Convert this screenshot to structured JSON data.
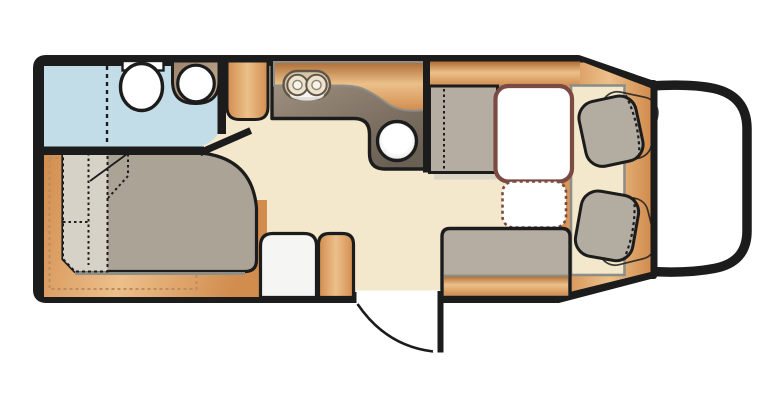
{
  "meta": {
    "type": "floorplan",
    "subject": "semi-integrated motorhome layout, top view",
    "orientation": "driver cab on the right, rear bedroom on the left"
  },
  "palette": {
    "outline": "#1c1c1c",
    "floor": "#f3e8cb",
    "washroomFloor": "#c3dde8",
    "woodLight": "#ecc08a",
    "woodMid": "#d28c4e",
    "woodDark": "#ad6c36",
    "counterLight": "#a79786",
    "counterDark": "#6b6054",
    "cushionGrey": "#b5ada1",
    "mattressGrey": "#aba396",
    "mattressLight": "#d7d2c8",
    "tableBorder": "#7b4a42",
    "seatGrey": "#b3aca1",
    "white": "#ffffff",
    "trimGrey": "#8e8e88",
    "shadow": "#dbd4c5",
    "basinBrown": "#9b8269",
    "basinLight": "#c9b296",
    "hobFace": "#d9c6a8",
    "hobLine": "#60564a",
    "dashWood": "#bd8c5e"
  },
  "areas": {
    "washroom": {
      "fixtures": [
        "toilet",
        "washbasin",
        "shower-partition",
        "washroom-door"
      ]
    },
    "kitchen": {
      "fixtures": [
        "hob-2-burner",
        "round-sink",
        "worktop",
        "tall-cabinet"
      ]
    },
    "dinette": {
      "fixtures": [
        "table",
        "table-extension",
        "side-bench-seat",
        "front-bench-seat"
      ]
    },
    "cab": {
      "fixtures": [
        "driver-swivel-seat",
        "passenger-swivel-seat",
        "vehicle-nose",
        "windscreen"
      ]
    },
    "bedroom": {
      "fixtures": [
        "double-bed",
        "folded-bed-section",
        "under-bed-storage"
      ]
    },
    "entrance": {
      "fixtures": [
        "entry-door",
        "door-swing-arc",
        "wardrobe",
        "wood-pillar"
      ]
    }
  }
}
